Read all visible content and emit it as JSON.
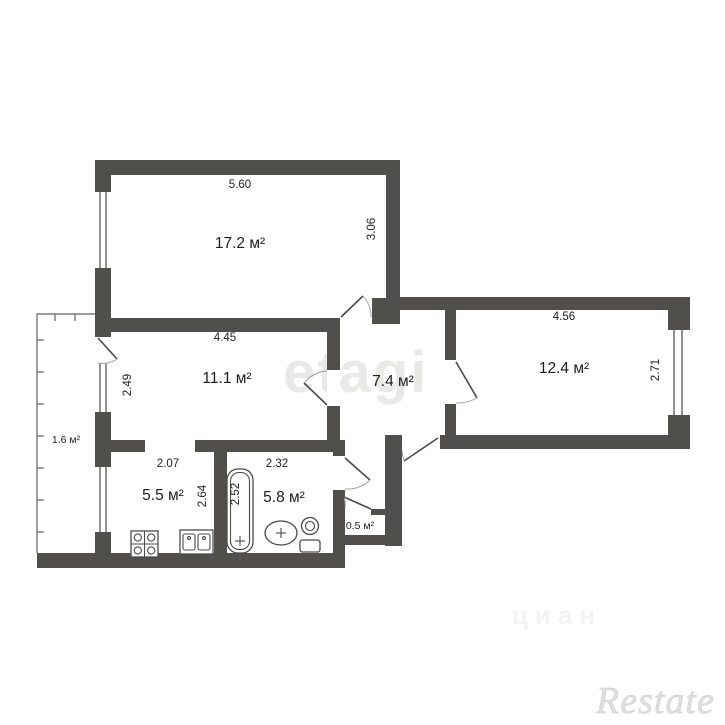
{
  "plan_title": "apartment-floor-plan",
  "rooms": [
    {
      "id": "room-17-2",
      "area": "17.2 м²"
    },
    {
      "id": "room-11-1",
      "area": "11.1 м²"
    },
    {
      "id": "hallway",
      "area": "7.4 м²"
    },
    {
      "id": "room-12-4",
      "area": "12.4 м²"
    },
    {
      "id": "balcony",
      "area": "1.6 м²"
    },
    {
      "id": "kitchen",
      "area": "5.5 м²"
    },
    {
      "id": "bathroom",
      "area": "5.8 м²"
    },
    {
      "id": "closet",
      "area": "0.5 м²"
    }
  ],
  "dimensions": {
    "room_17_2_width": "5.60",
    "room_17_2_depth": "3.06",
    "room_11_1_width": "4.45",
    "room_11_1_depth": "2.49",
    "room_12_4_width": "4.56",
    "room_12_4_depth": "2.71",
    "kitchen_width": "2.07",
    "kitchen_depth": "2.64",
    "bathroom_width": "2.32",
    "bathroom_depth": "2.52"
  },
  "watermarks": {
    "center": "etagi",
    "bottom_right_logo": "Restate",
    "faint": "циан"
  },
  "colors": {
    "wall": "#514f4c",
    "text": "#1d1d1d",
    "watermark_center": "#e9e9e7",
    "watermark_faint": "#f3f3f1",
    "watermark_logo": "#dedede"
  }
}
